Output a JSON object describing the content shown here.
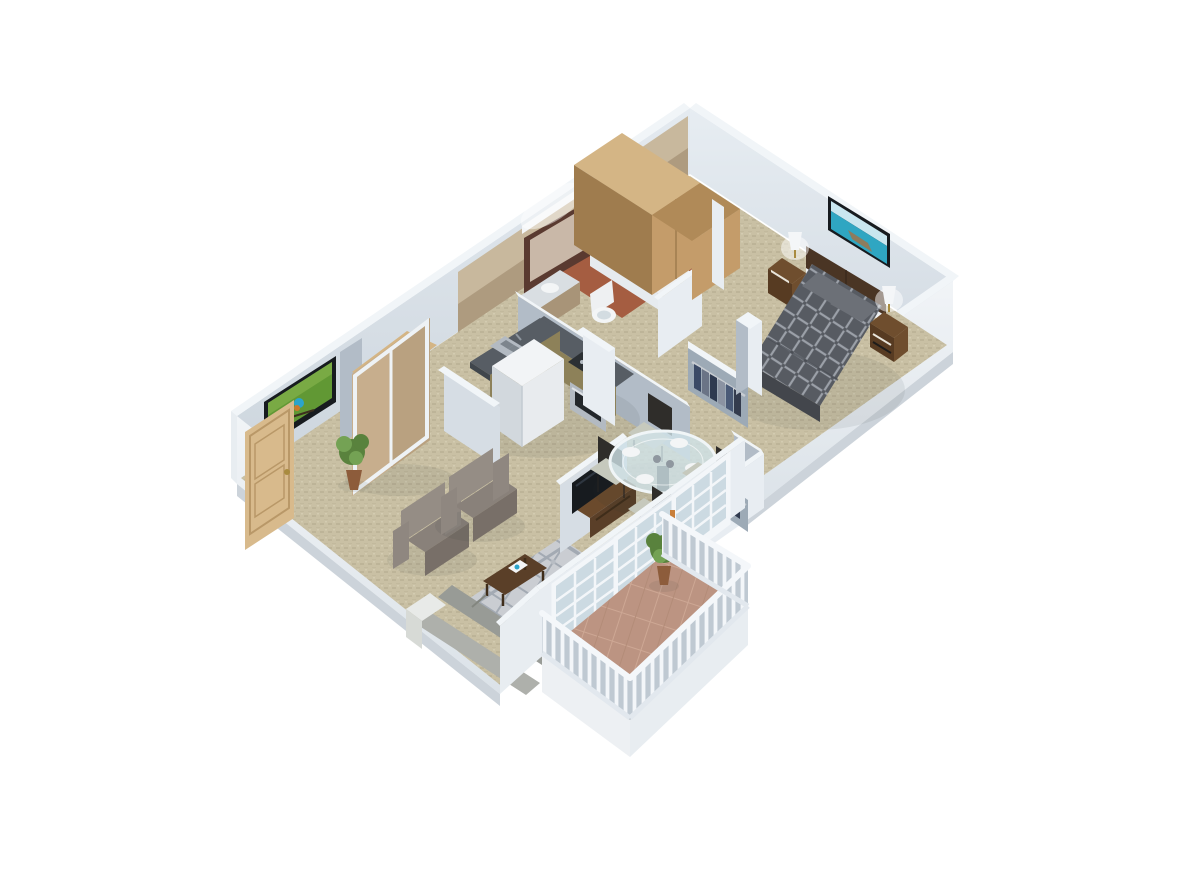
{
  "scene": {
    "description": "3D isometric architectural rendering of a one-bedroom apartment floor plan viewed from above at an angle, on a plain white background",
    "style": "photorealistic dollhouse cutaway with white-topped walls and beige carpet",
    "rooms": [
      {
        "name": "living-room",
        "floor": "beige carpet",
        "furniture": [
          "wall-mounted tv showing kingfisher bird",
          "entry door (light wood)",
          "sliding-door closet",
          "potted plant",
          "two gray armchairs",
          "patterned area rug",
          "dark wood coffee table",
          "gray sofa",
          "white side table"
        ]
      },
      {
        "name": "kitchen",
        "floor": "beige carpet",
        "furniture": [
          "L-shaped counter with gray top",
          "double stainless sink",
          "cooktop and oven",
          "white refrigerator",
          "tan cabinet fronts"
        ]
      },
      {
        "name": "dining-area",
        "floor": "beige carpet",
        "furniture": [
          "round glass pedestal table",
          "four dark dining chairs",
          "white place settings"
        ]
      },
      {
        "name": "bathroom",
        "floor": "terracotta tile",
        "furniture": [
          "framed vanity mirror with light",
          "vanity sink",
          "toilet",
          "bathtub with glass screen",
          "towel shelf"
        ]
      },
      {
        "name": "bedroom",
        "floor": "beige carpet",
        "furniture": [
          "queen bed with dark trellis-pattern duvet",
          "dark wood headboard",
          "two nightstands with lit lamps",
          "beach canvas art",
          "tall oak wardrobe",
          "closet with hanging clothes"
        ]
      },
      {
        "name": "hallway-closets",
        "floor": "beige carpet",
        "furniture": [
          "closet with hanging clothes",
          "interior partition walls"
        ]
      },
      {
        "name": "balcony",
        "floor": "terracotta tile",
        "furniture": [
          "white balustrade railing",
          "french glass doors",
          "potted shrub"
        ]
      }
    ]
  },
  "colors": {
    "pageBg": "#ffffff",
    "wallTop": "#f1f5f8",
    "wallFaceLight": "#d6dde4",
    "wallFaceLighter": "#e8edf2",
    "wallFaceShade": "#b2bcc7",
    "wallFaceDeep": "#9daab6",
    "wallExterior": "#e8edf1",
    "wallExtBase": "#ccd3da",
    "slabLight": "#edf0f3",
    "tanTop": "#c8b89d",
    "tanBottom": "#a89478",
    "carpet": "#c9c0a4",
    "carpetWeave": "#bdb498",
    "terracotta": "#a55d41",
    "terracottaLight": "#b97356",
    "balconyTile": "#bc9482",
    "tileGrout": "#cda794",
    "woodDoor": "#d8ba8c",
    "woodDoorEdge": "#b99868",
    "woodWardrobeTop": "#d4b585",
    "woodWardrobe": "#c49c6a",
    "woodWardrobeDark": "#b08a58",
    "woodWardrobeSide": "#9f7c4e",
    "nightstandWood": "#6f4e2e",
    "nightstandDark": "#573b22",
    "headboard": "#4a3524",
    "furnWoodDark": "#5a3f28",
    "furnWoodMid": "#6b4a2c",
    "counterTop": "#575d64",
    "counterEdge": "#40464c",
    "cabinetFace": "#8d8159",
    "cabinetDark": "#766b48",
    "steel": "#b3bac2",
    "steelDark": "#8f979f",
    "fridgeTop": "#f2f4f6",
    "fridgeFront": "#e8ebee",
    "fridgeSide": "#d2d8dd",
    "duvet": "#575b62",
    "duvetLine": "#9ba0a8",
    "duvetLight": "#6c7077",
    "bedSide": "#43464c",
    "mattress": "#eef0f2",
    "lampShade": "#f4f6f8",
    "chairBack": "#958d85",
    "chairSeat": "#89817a",
    "chairFront": "#786f68",
    "chairArm": "#8f8780",
    "rugBase": "#cacdd2",
    "rugPattern": "#a3aab3",
    "sofaSeat": "#989b96",
    "sofaBack": "#aeb0ab",
    "sofaArm": "#e8eae8",
    "diningChair": "#2f2d2a",
    "diningSeat": "#c6c9bd",
    "glassFill": "#cfe2e8",
    "glassRim": "#f0f5f7",
    "plate": "#f3f5f6",
    "plantGreen": "#59823d",
    "plantLight": "#74a254",
    "pot": "#8d5c3b",
    "tvFrame": "#171b1f",
    "tvGreen": "#619834",
    "birdBlue": "#2ba4cc",
    "birdOrange": "#cd7a2c",
    "picSky": "#c9e6ef",
    "picSea": "#2fa6c2",
    "picPier": "#8d7c5e",
    "doorGlass": "#ccdae2",
    "muntin": "#f3f6f9",
    "baluster": "#f3f6f9",
    "balusterBg": "#bfc9d2",
    "shadow": "#2a3038",
    "glow": "#ffffff"
  }
}
